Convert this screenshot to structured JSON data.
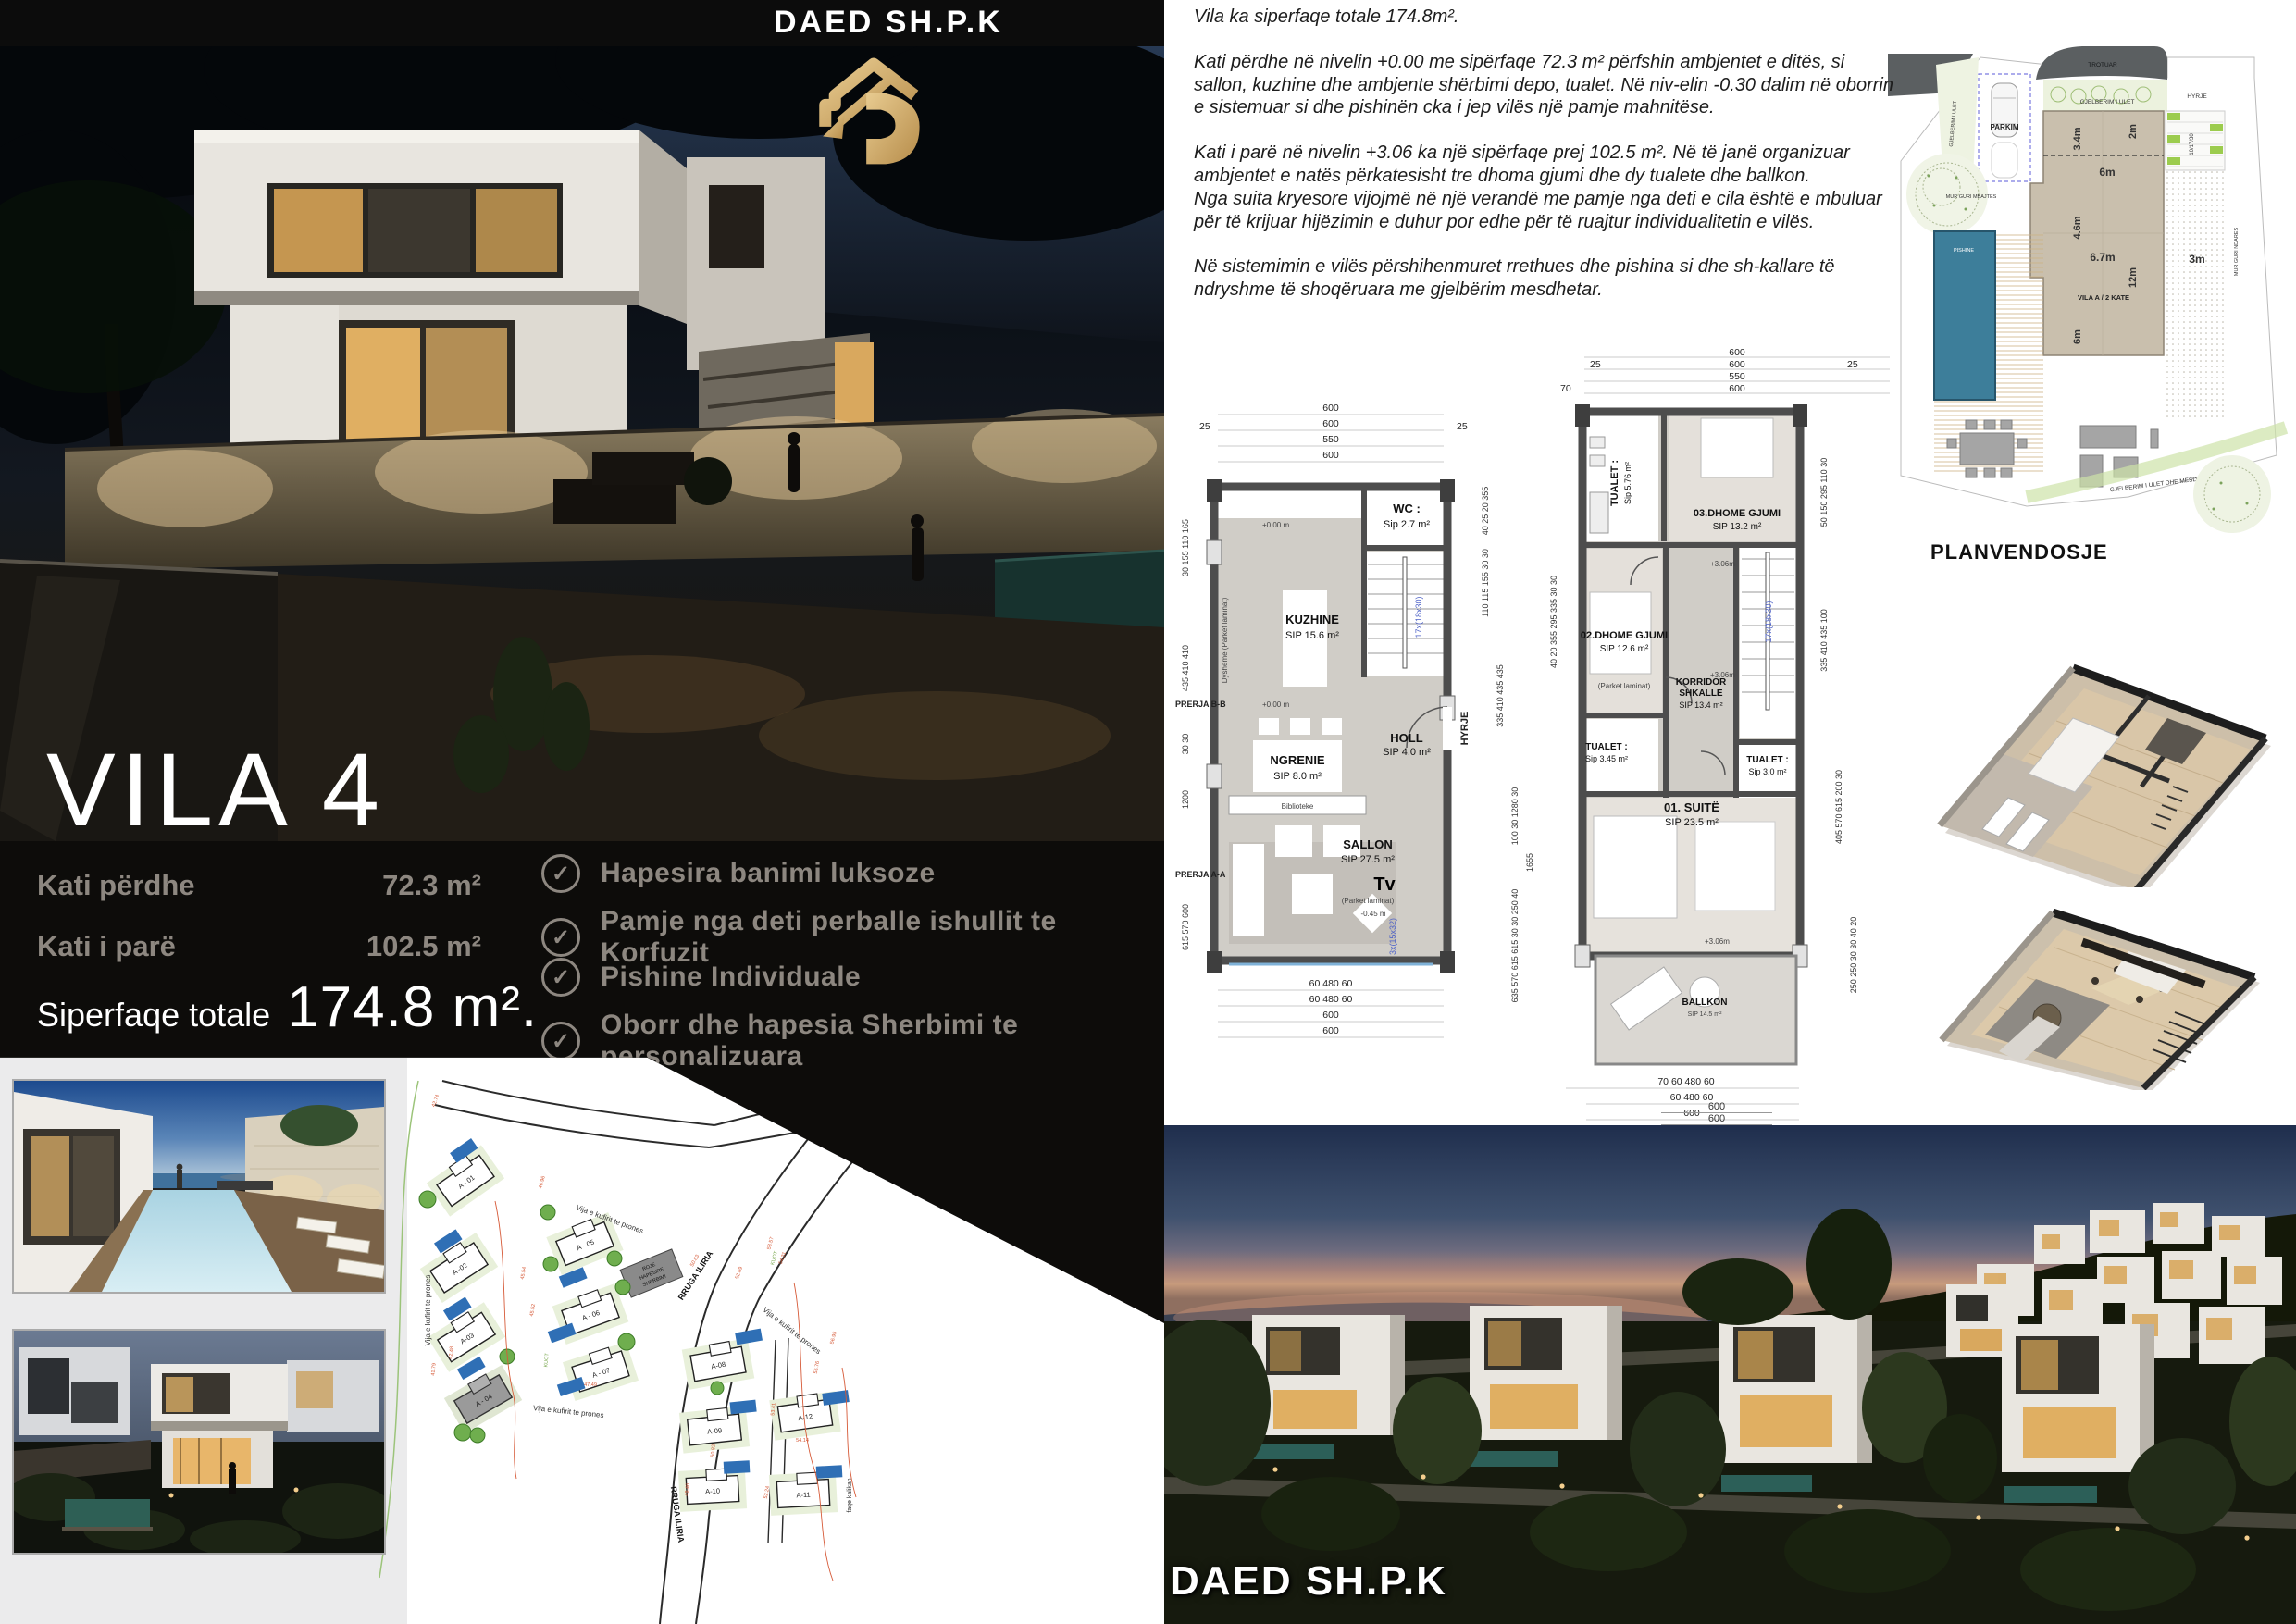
{
  "brand": {
    "top": "DAED SH.P.K",
    "bottom": "DAED SH.P.K"
  },
  "hero": {
    "title": "VILA 4"
  },
  "stats": {
    "rows": [
      {
        "label": "Kati përdhe",
        "value": "72.3 m²"
      },
      {
        "label": "Kati i parë",
        "value": "102.5 m²"
      }
    ],
    "total_label": "Siperfaqe totale",
    "total_value": "174.8 m²."
  },
  "features": {
    "icon_glyph": "✓",
    "items": [
      "Hapesira banimi luksoze",
      "Pamje nga deti perballe ishullit te Korfuzit",
      "Pishine Individuale",
      "Oborr dhe hapesia Sherbimi te personalizuara"
    ]
  },
  "description": {
    "p1": "Vila ka  siperfaqe totale 174.8m².",
    "p2": "Kati përdhe në nivelin +0.00 me sipërfaqe 72.3 m² përfshin ambjentet e ditës, si sallon, kuzhine dhe ambjente shërbimi depo, tualet. Në niv-elin -0.30 dalim në oborrin e sistemuar si dhe pishinën cka i jep vilës një pamje mahnitëse.",
    "p3": "Kati i parë në nivelin +3.06 ka një sipërfaqe prej 102.5 m². Në të janë organizuar ambjentet e natës përkatesisht tre dhoma gjumi dhe dy tualete dhe ballkon.",
    "p4": "Nga suita kryesore vijojmë në një verandë me pamje nga deti e cila është e mbuluar",
    "p5": "për të krijuar hijëzimin e duhur por edhe për të ruajtur individualitetin e vilës.",
    "p6": "Në sistemimin e vilës përshihenmuret rrethues dhe pishina si dhe sh-kallare të ndryshme të shoqëruara me gjelbërim mesdhetar."
  },
  "plan_ground": {
    "top_dims": [
      "600",
      "600",
      "550",
      "600"
    ],
    "top_left": "25",
    "top_right": "25",
    "bottom_dims": [
      "60  480  60",
      "60  480  60",
      "600",
      "600"
    ],
    "left_dims": [
      "30 155 110 165",
      "435 410 410",
      "30 30",
      "1200",
      "615 570 600"
    ],
    "section_b": "PRERJA B-B",
    "section_a": "PRERJA A-A",
    "right_dims": [
      "40 25 20 355",
      "110 115 155 30 30",
      "335 410 435 435",
      "100 30 1280 30",
      "1655",
      "635 570 615 615 30 30 250 40"
    ],
    "rooms": {
      "kuzhine": {
        "name": "KUZHINE",
        "area": "SIP 15.6  m²"
      },
      "wc": {
        "name": "WC :",
        "area": "Sip 2.7 m²"
      },
      "ngrenie": {
        "name": "NGRENIE",
        "area": "SIP  8.0  m²"
      },
      "holl": {
        "name": "HOLL",
        "area": "SIP  4.0 m²"
      },
      "sallon": {
        "name": "SALLON",
        "area": "SIP 27.5 m²"
      },
      "tv": "Tv",
      "biblioteke": "Biblioteke",
      "floor_note": "(Parket  laminat)",
      "wall_note": "Dysheme (Parket  laminat)",
      "level_0": "+0.00 m",
      "level_neg": "-0.45 m",
      "stairs": "17x(18x30)",
      "stairs2": "3x(15x32)",
      "hyrje": "HYRJE"
    }
  },
  "plan_first": {
    "top_dims": [
      "600",
      "600",
      "550",
      "600"
    ],
    "top_left1": "25",
    "top_left2": "70",
    "top_right": "25",
    "bottom_dims": [
      "70  60  480  60",
      "60  480  60",
      "600",
      "600"
    ],
    "left_dims": "40 20 355 295 335 30 30",
    "right_dims": [
      "50 150 295 110 30",
      "335 410 435 100",
      "405 570 615 200 30",
      "250 250 30 30 40 20"
    ],
    "rooms": {
      "tualet1": {
        "name": "TUALET :",
        "area": "Sip 5.76 m²"
      },
      "dhome3": {
        "name": "03.DHOME GJUMI",
        "area": "SIP  13.2 m²"
      },
      "dhome2": {
        "name": "02.DHOME GJUMI",
        "area": "SIP  12.6 m²"
      },
      "korridor": {
        "name": "KORRIDOR",
        "name2": "SHKALLE",
        "area": "SIP 13.4 m²"
      },
      "tualet2": {
        "name": "TUALET :",
        "area": "Sip 3.45 m²"
      },
      "tualet3": {
        "name": "TUALET :",
        "area": "Sip 3.0 m²"
      },
      "suite": {
        "name": "01. SUITË",
        "area": "SIP 23.5 m²"
      },
      "ballkon": {
        "name": "BALLKON",
        "area": "SIP 14.5 m²"
      },
      "floor_note": "(Parket  laminat)",
      "level": "+3.06m",
      "stairs": "17x(18x30)"
    }
  },
  "siteplan": {
    "title": "PLANVENDOSJE",
    "labels": {
      "trotuar": "TROTUAR",
      "gjelberim": "GJELBERIM I ULET",
      "gjelberim_left": "GJELBERIM I ULET",
      "parkim": "PARKIM",
      "hyrje": "HYRJE",
      "stair": "10/17/30",
      "vila": "VILA A / 2 KATE",
      "mur_mbajtes": "MUR GURI MBAJTES",
      "mur_ndares": "MUR GURI NDARES",
      "pishine": "PISHINE",
      "gjelberim2": "GJELBERIM I ULET DHE MESDHETARE"
    },
    "dims": {
      "d34": "3.4m",
      "d2": "2m",
      "d6a": "6m",
      "d46": "4.6m",
      "d67": "6.7m",
      "d12": "12m",
      "d6b": "6m",
      "d3": "3m"
    }
  },
  "masterplan": {
    "villas": [
      "A - 01",
      "A -02",
      "A-03",
      "A - 04",
      "A - 05",
      "A - 06",
      "A - 07",
      "A-08",
      "A-09",
      "A-10",
      "A-11",
      "A-12"
    ],
    "street": "RRUGA ILIRIA",
    "boundary": "Vija e kufirit te prones",
    "roje": [
      "ROJE",
      "HAPESIRE",
      "SHERBIMI"
    ],
    "kalikan": "faqe kalikan",
    "kuot": "KUOT",
    "elevations": [
      "42.74",
      "45.54",
      "45.52",
      "46.96",
      "47.49",
      "50.63",
      "52.69",
      "53.57",
      "54.31",
      "55.76",
      "50.82",
      "49.46",
      "53.41",
      "52.24",
      "54.14",
      "41.79",
      "42.48",
      "56.95"
    ]
  },
  "render": {
    "dims": [
      "600",
      "600"
    ]
  },
  "colors": {
    "gold": "#c9a263",
    "panel": "#0d0c0a",
    "muted": "#8d8780",
    "pool": "#2f6fb5",
    "contour": "#d65a38"
  }
}
